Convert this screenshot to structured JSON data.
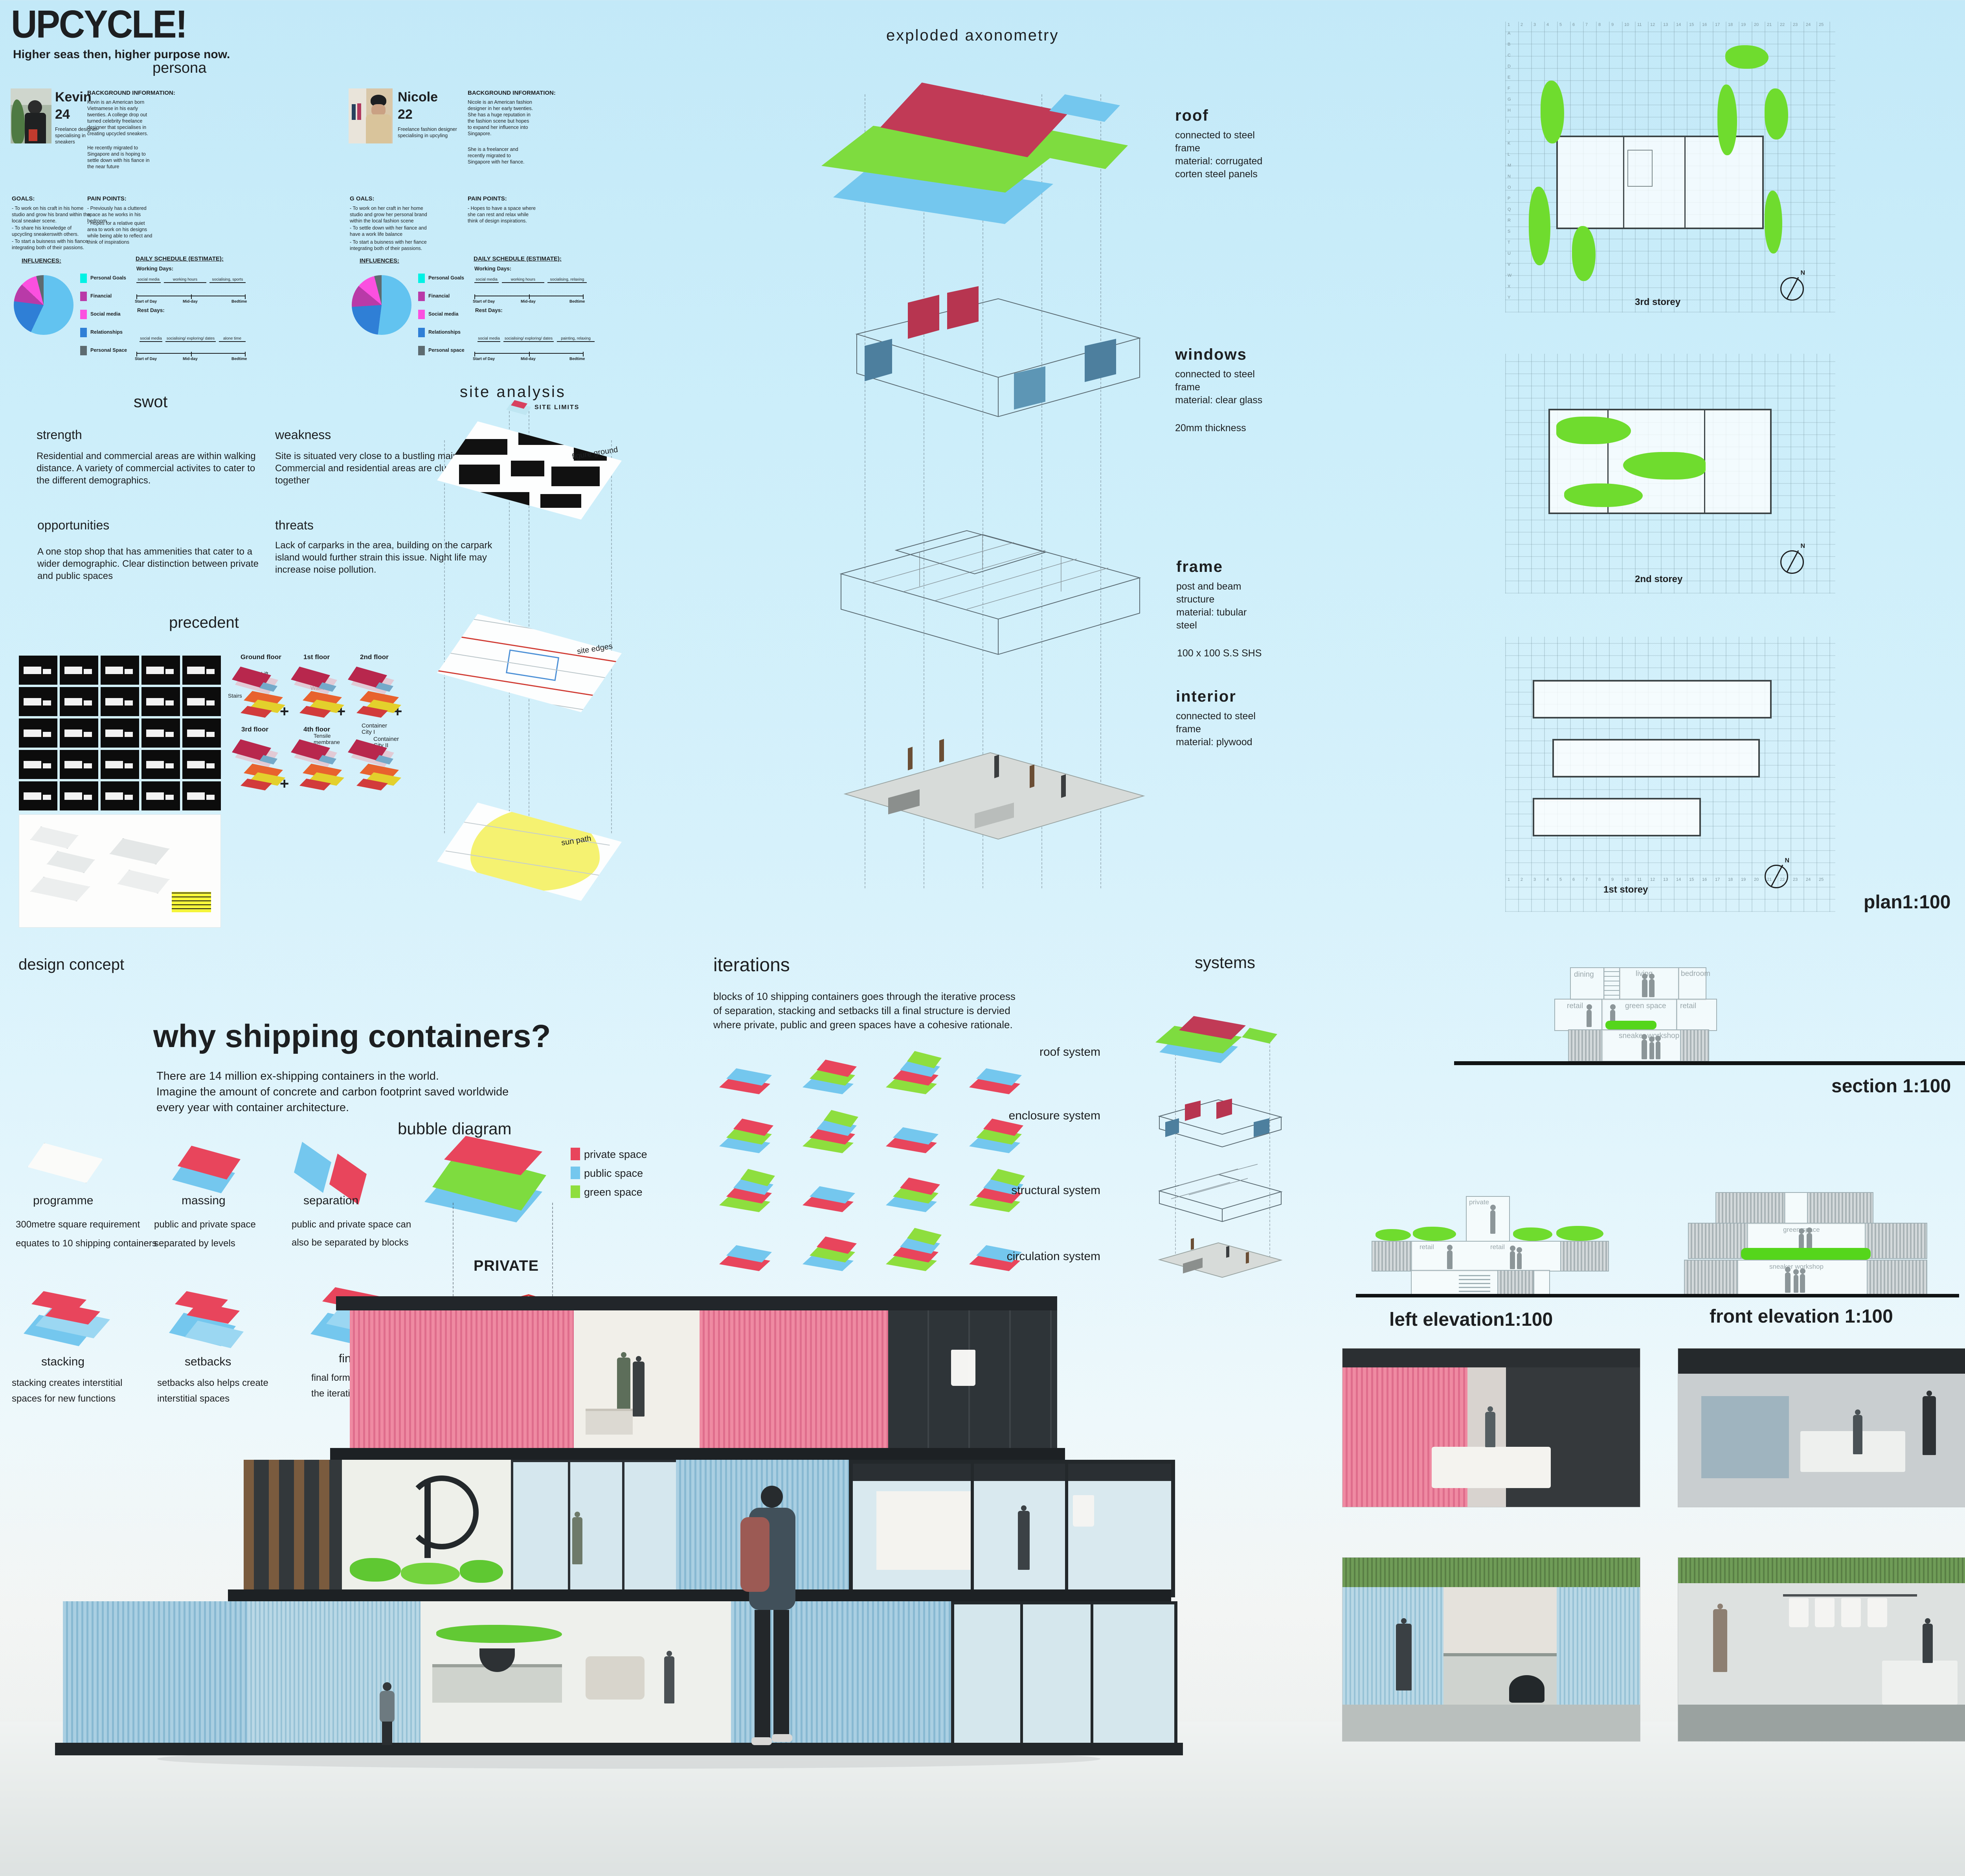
{
  "header": {
    "title": "UPCYCLE!",
    "subtitle": "Higher seas then, higher purpose now.",
    "persona_heading": "persona"
  },
  "personas": [
    {
      "name": "Kevin",
      "age": "24",
      "role_lines": [
        "Freelance designer",
        "specialising in",
        "sneakers"
      ],
      "background_heading": "BACKGROUND INFORMATION:",
      "background_1": "Kevin is an American born Vietnamese in his early twenties. A college drop out turned celebrity freelance designer that specialises in creating upcycled sneakers.",
      "background_2": "He recently migrated to Singapore and is hoping to settle down with his fiance in the near future",
      "goals_heading": "GOALS:",
      "goals": [
        "- To work on his craft in his home studio and grow his brand within the local sneaker scene.",
        "- To share his knowledge of upcycling sneakerswith others.",
        "- To start a buisness with his fiance integrating both of their passions."
      ],
      "pain_heading": "PAIN POINTS:",
      "pains": [
        "- Previously has a cluttered space as he works in his bedroom",
        "- Hopes for a relative quiet area to work on his designs while being able to reflect and think of inspirations"
      ],
      "influences_heading": "INFLUENCES:",
      "legend": [
        {
          "label": "Personal Goals",
          "color": "#00f2e4"
        },
        {
          "label": "Financial",
          "color": "#b93aa8"
        },
        {
          "label": "Social media",
          "color": "#fb50e0"
        },
        {
          "label": "Relationships",
          "color": "#2f7fd6"
        },
        {
          "label": "Personal Space",
          "color": "#5d6b70"
        }
      ],
      "influences_pie": [
        {
          "color": "#62c3f0",
          "value": 57
        },
        {
          "color": "#2f7fd6",
          "value": 20
        },
        {
          "color": "#b93aa8",
          "value": 10
        },
        {
          "color": "#fb50e0",
          "value": 9
        },
        {
          "color": "#5d6b70",
          "value": 4
        }
      ],
      "schedule_heading": "DAILY SCHEDULE (ESTIMATE):",
      "working_days_label": "Working Days:",
      "working_segments": [
        "social media",
        "working hours",
        "socialising, sports"
      ],
      "rest_days_label": "Rest Days:",
      "rest_segments": [
        "social media",
        "socialising/ exploring/ dates",
        "alone time"
      ],
      "timeline_labels": [
        "Start of Day",
        "Mid-day",
        "Bedtime"
      ]
    },
    {
      "name": "Nicole",
      "age": "22",
      "role_lines": [
        "Freelance fashion designer",
        "specialising in upcyling",
        ""
      ],
      "background_heading": "BACKGROUND INFORMATION:",
      "background_1": "Nicole is an American fashion designer in her early twenties. She has a huge reputation in the fashion scene but hopes to expand her influence into Singapore.",
      "background_2": "She is a freelancer and recently migrated to Singapore with her fiance.",
      "goals_heading": "G OALS:",
      "goals": [
        "- To work on her craft in her home studio and grow her personal brand within the local fashion scene",
        "- To settle down with her fiance and have a work life balance",
        "- To start a buisness with her fiance integrating both of their passions."
      ],
      "pain_heading": "PAIN POINTS:",
      "pains": [
        "- Hopes to have a space where she can rest and relax while think of design inspirations."
      ],
      "influences_heading": "INFLUENCES:",
      "legend": [
        {
          "label": "Personal Goals",
          "color": "#00f2e4"
        },
        {
          "label": "Financial",
          "color": "#b93aa8"
        },
        {
          "label": "Social media",
          "color": "#fb50e0"
        },
        {
          "label": "Relationships",
          "color": "#2f7fd6"
        },
        {
          "label": "Personal space",
          "color": "#5d6b70"
        }
      ],
      "influences_pie": [
        {
          "color": "#62c3f0",
          "value": 52
        },
        {
          "color": "#2f7fd6",
          "value": 22
        },
        {
          "color": "#b93aa8",
          "value": 12
        },
        {
          "color": "#fb50e0",
          "value": 10
        },
        {
          "color": "#5d6b70",
          "value": 4
        }
      ],
      "schedule_heading": "DAILY SCHEDULE (ESTIMATE):",
      "working_days_label": "Working Days:",
      "working_segments": [
        "social media",
        "working hours",
        "socialising, relaxing"
      ],
      "rest_days_label": "Rest Days:",
      "rest_segments": [
        "social media",
        "socialising/ exploring/ dates",
        "painting, relaxing"
      ],
      "timeline_labels": [
        "Start of Day",
        "Mid-day",
        "Bedtime"
      ]
    }
  ],
  "swot": {
    "heading": "swot",
    "strength": {
      "title": "strength",
      "text": "Residential and commercial areas are within walking distance. A variety of commercial activites to cater to the different demographics."
    },
    "weakness": {
      "title": "weakness",
      "text": "Site is situated very close to a bustling main road. Commercial and residential areas are clustered closely together"
    },
    "opportunities": {
      "title": "opportunities",
      "text": "A one stop shop that has ammenities that cater to a wider demographic. Clear distinction between private and public spaces"
    },
    "threats": {
      "title": "threats",
      "text": "Lack of carparks in the area, building on the carpark island would further strain this issue. Night life may increase noise pollution."
    }
  },
  "site_analysis": {
    "heading": "site analysis",
    "site_limits": "SITE LIMITS",
    "layers": [
      "figure ground",
      "site edges",
      "sun path"
    ]
  },
  "precedent": {
    "heading": "precedent",
    "floors": [
      "Ground floor",
      "1st floor",
      "2nd floor",
      "3rd floor",
      "4th floor"
    ],
    "stairs": "Stairs",
    "lift": "Lift",
    "walkway": "Walkway",
    "tensile_lines": [
      "Tensile",
      "membrane",
      "roof"
    ],
    "cc1_lines": [
      "Container",
      "City I"
    ],
    "cc2_lines": [
      "Container",
      "City II"
    ],
    "plus": "+"
  },
  "axonometry": {
    "heading": "exploded axonometry",
    "layers": [
      {
        "name": "roof",
        "lines": [
          "connected to steel",
          "frame",
          "material: corrugated",
          "corten steel panels"
        ],
        "extra": ""
      },
      {
        "name": "windows",
        "lines": [
          "connected to steel",
          "frame",
          "material: clear glass"
        ],
        "extra": "20mm thickness"
      },
      {
        "name": "frame",
        "lines": [
          "post and beam",
          "structure",
          "material: tubular",
          "steel"
        ],
        "extra": "100 x 100 S.S SHS"
      },
      {
        "name": "interior",
        "lines": [
          "connected to steel",
          "frame",
          "material: plywood"
        ],
        "extra": ""
      }
    ]
  },
  "plans": {
    "storeys": [
      "3rd storey",
      "2nd storey",
      "1st storey"
    ],
    "scale_label": "plan1:100",
    "north": "N",
    "grid_numbers": [
      "1",
      "2",
      "3",
      "4",
      "5",
      "6",
      "7",
      "8",
      "9",
      "10",
      "11",
      "12",
      "13",
      "14",
      "15",
      "16",
      "17",
      "18",
      "19",
      "20",
      "21",
      "22",
      "23",
      "24",
      "25"
    ],
    "grid_letters": [
      "A",
      "B",
      "C",
      "D",
      "E",
      "F",
      "G",
      "H",
      "I",
      "J",
      "K",
      "L",
      "M",
      "N",
      "O",
      "P",
      "Q",
      "R",
      "S",
      "T",
      "U",
      "V",
      "W",
      "X",
      "Y"
    ]
  },
  "design_concept": {
    "heading": "design concept",
    "big_heading": "why shipping containers?",
    "paragraph": [
      "There are 14 million ex-shipping containers in the world.",
      "Imagine the amount of concrete and carbon footprint saved worldwide",
      "every year with container architecture."
    ],
    "bubble_heading": "bubble diagram",
    "steps": [
      {
        "label": "programme",
        "desc": [
          "300metre square requirement",
          "equates to 10 shipping containers"
        ]
      },
      {
        "label": "massing",
        "desc": [
          "public and private space",
          "separated by levels"
        ]
      },
      {
        "label": "separation",
        "desc": [
          "public and private space can",
          "also be separated by blocks"
        ]
      },
      {
        "label": "stacking",
        "desc": [
          "stacking creates interstitial",
          "spaces for new functions"
        ]
      },
      {
        "label": "setbacks",
        "desc": [
          "setbacks also helps create",
          "interstitial spaces"
        ]
      },
      {
        "label": "final",
        "desc": [
          "final form is created through",
          "the iterative process"
        ]
      }
    ],
    "legend": [
      {
        "label": "private space",
        "color": "#e8455c"
      },
      {
        "label": "public space",
        "color": "#74c7ee"
      },
      {
        "label": "green space",
        "color": "#8ede3e"
      }
    ],
    "zones": [
      "PRIVATE",
      "WORKSHOP",
      "RETAIL"
    ]
  },
  "iterations": {
    "heading": "iterations",
    "lines": [
      "blocks of 10 shipping containers goes through the iterative process",
      "of separation, stacking and setbacks till a final structure is dervied",
      "where private, public and green spaces have a cohesive rationale."
    ]
  },
  "systems": {
    "heading": "systems",
    "items": [
      "roof system",
      "enclosure system",
      "structural system",
      "circulation system"
    ]
  },
  "section": {
    "label": "section 1:100",
    "rooms": [
      "dining",
      "living",
      "bedroom",
      "retail",
      "green space",
      "retail",
      "sneaker workshop"
    ]
  },
  "elevations": {
    "left_label": "left elevation1:100",
    "front_label": "front elevation 1:100",
    "left_rooms": [
      "private",
      "retail",
      "retail"
    ],
    "front_rooms": [
      "green space",
      "sneaker workshop"
    ]
  }
}
